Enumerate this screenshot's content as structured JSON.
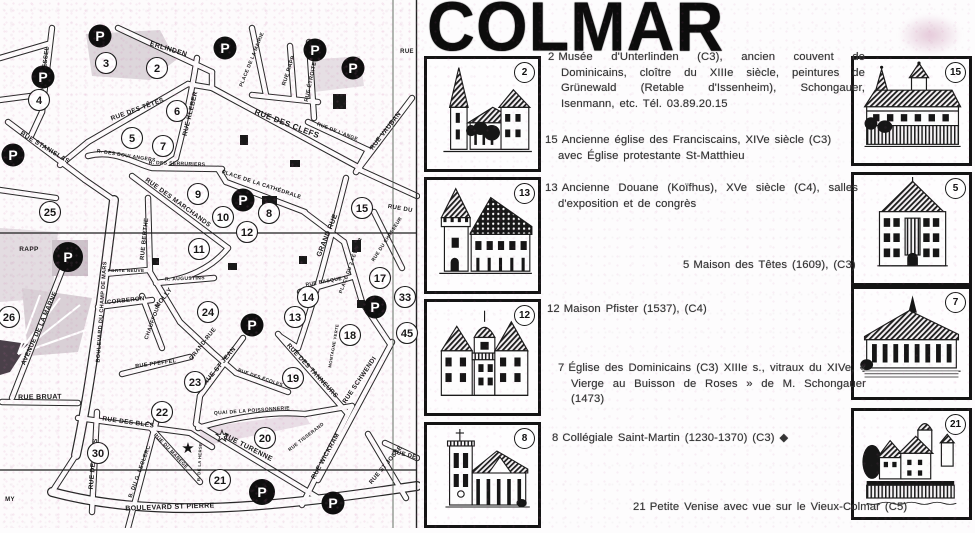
{
  "title": "COLMAR",
  "map": {
    "parking_label": "P",
    "street_labels": [
      {
        "t": "ERLINDEN",
        "x": 168,
        "y": 51,
        "r": 17,
        "s": 7
      },
      {
        "t": "RUE ROESSEL",
        "x": 46,
        "y": 70,
        "r": -83,
        "s": 6
      },
      {
        "t": "RUE KLEBER",
        "x": 192,
        "y": 114,
        "r": -76,
        "s": 6.5
      },
      {
        "t": "RUE DES TÊTES",
        "x": 138,
        "y": 111,
        "r": -20,
        "s": 6.5
      },
      {
        "t": "RUE STANISLAS",
        "x": 44,
        "y": 149,
        "r": 31,
        "s": 6.5
      },
      {
        "t": "R. DES BOULANGERS",
        "x": 126,
        "y": 157,
        "r": 9,
        "s": 5
      },
      {
        "t": "R. DES SERRURIERS",
        "x": 177,
        "y": 165,
        "r": 2,
        "s": 5
      },
      {
        "t": "RUE DES CLEFS",
        "x": 286,
        "y": 126,
        "r": 21,
        "s": 8
      },
      {
        "t": "PLACE DE LA MAIRIE",
        "x": 253,
        "y": 60,
        "r": -68,
        "s": 5
      },
      {
        "t": "RUE RAPP",
        "x": 290,
        "y": 71,
        "r": -72,
        "s": 5.5
      },
      {
        "t": "RUE ÉTROITE",
        "x": 312,
        "y": 82,
        "r": -78,
        "s": 5.5
      },
      {
        "t": "RUE DE L'ANGE",
        "x": 337,
        "y": 133,
        "r": 21,
        "s": 5
      },
      {
        "t": "RUE VAUBAN",
        "x": 387,
        "y": 132,
        "r": -52,
        "s": 6.5
      },
      {
        "t": "RUE",
        "x": 407,
        "y": 53,
        "r": 0,
        "s": 6
      },
      {
        "t": "RUE DES MARCHANDS",
        "x": 177,
        "y": 204,
        "r": 36,
        "s": 6.5
      },
      {
        "t": "PLACE DE LA CATHÉDRALE",
        "x": 261,
        "y": 186,
        "r": 18,
        "s": 5.5
      },
      {
        "t": "GRAND RUE",
        "x": 329,
        "y": 236,
        "r": -68,
        "s": 7
      },
      {
        "t": "RUE BERTHE",
        "x": 146,
        "y": 239,
        "r": -84,
        "s": 6
      },
      {
        "t": "MOLLY",
        "x": 165,
        "y": 299,
        "r": -52,
        "s": 6.5
      },
      {
        "t": "PORTE NEUVE",
        "x": 126,
        "y": 272,
        "r": 0,
        "s": 4.6
      },
      {
        "t": "CORBERON",
        "x": 126,
        "y": 302,
        "r": -6,
        "s": 6
      },
      {
        "t": "R. AUGUSTINS",
        "x": 185,
        "y": 280,
        "r": -2,
        "s": 5
      },
      {
        "t": "BOULEVARD DU CHAMP DE MARS",
        "x": 103,
        "y": 312,
        "r": -86,
        "s": 5.5
      },
      {
        "t": "AVENUE DE LA MARNE",
        "x": 41,
        "y": 329,
        "r": -66,
        "s": 6.5
      },
      {
        "t": "RAPP",
        "x": 29,
        "y": 251,
        "r": 0,
        "s": 6.5
      },
      {
        "t": "RUE BRUAT",
        "x": 40,
        "y": 399,
        "r": -1,
        "s": 7
      },
      {
        "t": "RUE DE REIMS",
        "x": 95,
        "y": 464,
        "r": -85,
        "s": 6.5
      },
      {
        "t": "B. DU G. LECLERC",
        "x": 141,
        "y": 472,
        "r": -70,
        "s": 5.5
      },
      {
        "t": "BOULEVARD ST PIERRE",
        "x": 170,
        "y": 509,
        "r": -2,
        "s": 7
      },
      {
        "t": "RUE DES BLÉS",
        "x": 128,
        "y": 424,
        "r": 8,
        "s": 6.5
      },
      {
        "t": "RUE PFEFFEL",
        "x": 156,
        "y": 365,
        "r": -8,
        "s": 5.5
      },
      {
        "t": "CHAUFFOUR",
        "x": 154,
        "y": 322,
        "r": -70,
        "s": 5.5
      },
      {
        "t": "RUE DU MANÈGE",
        "x": 170,
        "y": 452,
        "r": 46,
        "s": 5
      },
      {
        "t": "R. DE LA HERSE",
        "x": 201,
        "y": 462,
        "r": -87,
        "s": 4.2
      },
      {
        "t": "QUAI DE LA POISSONNERIE",
        "x": 252,
        "y": 412,
        "r": -4,
        "s": 5
      },
      {
        "t": "RUE TURENNE",
        "x": 247,
        "y": 449,
        "r": 27,
        "s": 7
      },
      {
        "t": "RUE TISSERAND",
        "x": 307,
        "y": 438,
        "r": -38,
        "s": 4.8
      },
      {
        "t": "RUE WICKRAM",
        "x": 327,
        "y": 457,
        "r": -61,
        "s": 6.5
      },
      {
        "t": "RUE SCHWENDI",
        "x": 361,
        "y": 381,
        "r": -56,
        "s": 6.5
      },
      {
        "t": "RUE ST JOSSE",
        "x": 387,
        "y": 466,
        "r": -50,
        "s": 6
      },
      {
        "t": "RUE ST JEAN",
        "x": 221,
        "y": 367,
        "r": -50,
        "s": 6.5
      },
      {
        "t": "RUE DES ÉCOLES",
        "x": 260,
        "y": 379,
        "r": 19,
        "s": 4.8
      },
      {
        "t": "RUE DES TANNEURS",
        "x": 311,
        "y": 372,
        "r": 47,
        "s": 6.5
      },
      {
        "t": "GRAND-RUE",
        "x": 204,
        "y": 345,
        "r": -52,
        "s": 6
      },
      {
        "t": "PLACE DU 2 FÉVRIER",
        "x": 352,
        "y": 266,
        "r": -70,
        "s": 5
      },
      {
        "t": "RUE BASQUE",
        "x": 324,
        "y": 283,
        "r": -10,
        "s": 5
      },
      {
        "t": "MONTAGNE VERTE",
        "x": 335,
        "y": 346,
        "r": -80,
        "s": 4.2
      },
      {
        "t": "RUE DU CHASSEUR",
        "x": 388,
        "y": 240,
        "r": -57,
        "s": 4.8
      },
      {
        "t": "RUE DU",
        "x": 400,
        "y": 210,
        "r": 10,
        "s": 6
      },
      {
        "t": "RUE DE",
        "x": 404,
        "y": 456,
        "r": 14,
        "s": 6
      },
      {
        "t": "MY",
        "x": 10,
        "y": 501,
        "r": 0,
        "s": 6
      }
    ],
    "numbered_markers": [
      {
        "n": "3",
        "x": 106,
        "y": 63
      },
      {
        "n": "2",
        "x": 157,
        "y": 68
      },
      {
        "n": "4",
        "x": 39,
        "y": 100
      },
      {
        "n": "6",
        "x": 177,
        "y": 111
      },
      {
        "n": "5",
        "x": 132,
        "y": 138
      },
      {
        "n": "7",
        "x": 163,
        "y": 146
      },
      {
        "n": "9",
        "x": 198,
        "y": 194
      },
      {
        "n": "25",
        "x": 50,
        "y": 212
      },
      {
        "n": "10",
        "x": 223,
        "y": 217
      },
      {
        "n": "8",
        "x": 269,
        "y": 213
      },
      {
        "n": "15",
        "x": 362,
        "y": 208
      },
      {
        "n": "12",
        "x": 247,
        "y": 232
      },
      {
        "n": "11",
        "x": 199,
        "y": 249
      },
      {
        "n": "17",
        "x": 380,
        "y": 278
      },
      {
        "n": "14",
        "x": 308,
        "y": 297
      },
      {
        "n": "33",
        "x": 405,
        "y": 297
      },
      {
        "n": "24",
        "x": 208,
        "y": 312
      },
      {
        "n": "13",
        "x": 295,
        "y": 317
      },
      {
        "n": "26",
        "x": 9,
        "y": 317
      },
      {
        "n": "18",
        "x": 350,
        "y": 335
      },
      {
        "n": "45",
        "x": 407,
        "y": 333
      },
      {
        "n": "19",
        "x": 293,
        "y": 378
      },
      {
        "n": "23",
        "x": 195,
        "y": 382
      },
      {
        "n": "22",
        "x": 162,
        "y": 412
      },
      {
        "n": "20",
        "x": 265,
        "y": 438
      },
      {
        "n": "30",
        "x": 98,
        "y": 453
      },
      {
        "n": "21",
        "x": 220,
        "y": 480
      }
    ],
    "parking_markers": [
      {
        "x": 100,
        "y": 36
      },
      {
        "x": 225,
        "y": 48
      },
      {
        "x": 315,
        "y": 50
      },
      {
        "x": 353,
        "y": 68
      },
      {
        "x": 43,
        "y": 77
      },
      {
        "x": 13,
        "y": 155
      },
      {
        "x": 243,
        "y": 200
      },
      {
        "x": 68,
        "y": 257,
        "r": 15
      },
      {
        "x": 375,
        "y": 307
      },
      {
        "x": 252,
        "y": 325
      },
      {
        "x": 262,
        "y": 492,
        "r": 13
      },
      {
        "x": 333,
        "y": 503
      }
    ],
    "star_markers": [
      {
        "x": 188,
        "y": 448,
        "filled": true
      },
      {
        "x": 222,
        "y": 436,
        "filled": false
      }
    ]
  },
  "legend": {
    "left_thumbs": [
      {
        "number": "2",
        "name": "musee-unterlinden"
      },
      {
        "number": "13",
        "name": "ancienne-douane-koifhus"
      },
      {
        "number": "12",
        "name": "maison-pfister"
      },
      {
        "number": "8",
        "name": "collegiale-saint-martin"
      }
    ],
    "right_thumbs": [
      {
        "number": "15",
        "name": "eglise-franciscains"
      },
      {
        "number": "5",
        "name": "maison-des-tetes"
      },
      {
        "number": "7",
        "name": "eglise-dominicains"
      },
      {
        "number": "21",
        "name": "petite-venise"
      }
    ]
  },
  "entries": [
    {
      "num": "2",
      "text": "Musée d'Unterlinden (C3), ancien couvent de Dominicains, cloître du XIIIe siècle, peintures de Grünewald (Retable d'Issenheim), Schongauer, Isenmann, etc. Tél. 03.89.20.15"
    },
    {
      "num": "15",
      "text": "Ancienne église des Franciscains, XIVe siècle (C3) avec Église protestante St-Matthieu"
    },
    {
      "num": "13",
      "text": "Ancienne Douane (Koïfhus), XVe siècle (C4), salles d'exposition et de congrès"
    },
    {
      "num": "5",
      "text": "Maison des Têtes (1609), (C3)"
    },
    {
      "num": "12",
      "text": "Maison Pfister (1537), (C4)"
    },
    {
      "num": "7",
      "text": "Église des Dominicains (C3) XIIIe s., vitraux du XIVe, « Vierge au Buisson de Roses » de M. Schongauer (1473)"
    },
    {
      "num": "8",
      "text": "Collégiale Saint-Martin (1230-1370) (C3) ◆"
    },
    {
      "num": "21",
      "text": "Petite Venise avec vue sur le Vieux-Colmar (C5)"
    }
  ]
}
